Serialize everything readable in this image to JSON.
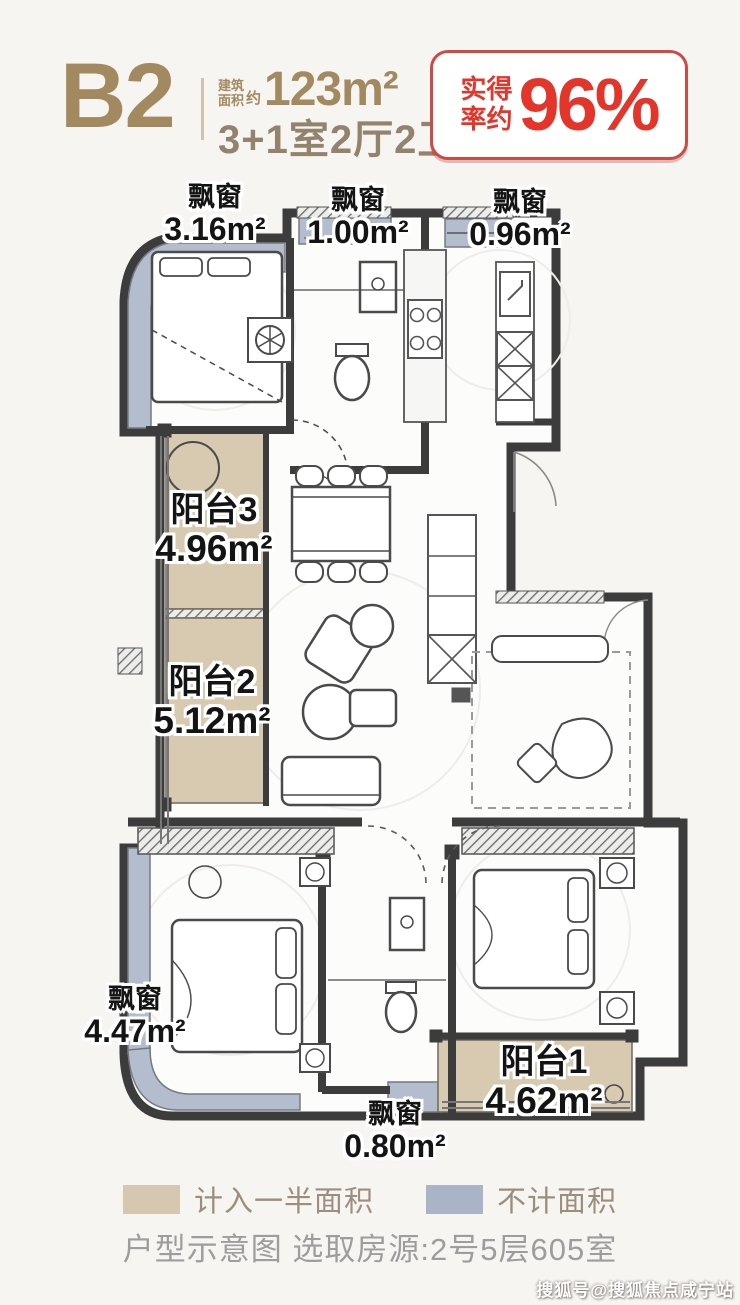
{
  "header": {
    "unit": "B2",
    "area_label_l1": "建筑",
    "area_label_l2": "面积",
    "area_approx": "约",
    "area_value": "123m²",
    "rooms": "3+1室2厅2卫",
    "badge": {
      "prefix_l1": "实得",
      "prefix_l2": "率约",
      "value": "96%"
    }
  },
  "plan": {
    "labels": [
      {
        "name": "飘窗",
        "area": "3.16m²"
      },
      {
        "name": "飘窗",
        "area": "1.00m²"
      },
      {
        "name": "飘窗",
        "area": "0.96m²"
      },
      {
        "name": "阳台3",
        "area": "4.96m²"
      },
      {
        "name": "阳台2",
        "area": "5.12m²"
      },
      {
        "name": "飘窗",
        "area": "4.47m²"
      },
      {
        "name": "阳台1",
        "area": "4.62m²"
      },
      {
        "name": "飘窗",
        "area": "0.80m²"
      }
    ]
  },
  "legend": {
    "half_area": {
      "label": "计入一半面积",
      "color": "#d5c7b0"
    },
    "excluded": {
      "label": "不计面积",
      "color": "#aab4c7"
    }
  },
  "caption": "户型示意图 选取房源:2号5层605室",
  "watermark": "搜狐号@搜狐焦点咸宁站",
  "colors": {
    "brand": "#a3895f",
    "red": "#e4352b",
    "wall": "#3c3c3c"
  }
}
